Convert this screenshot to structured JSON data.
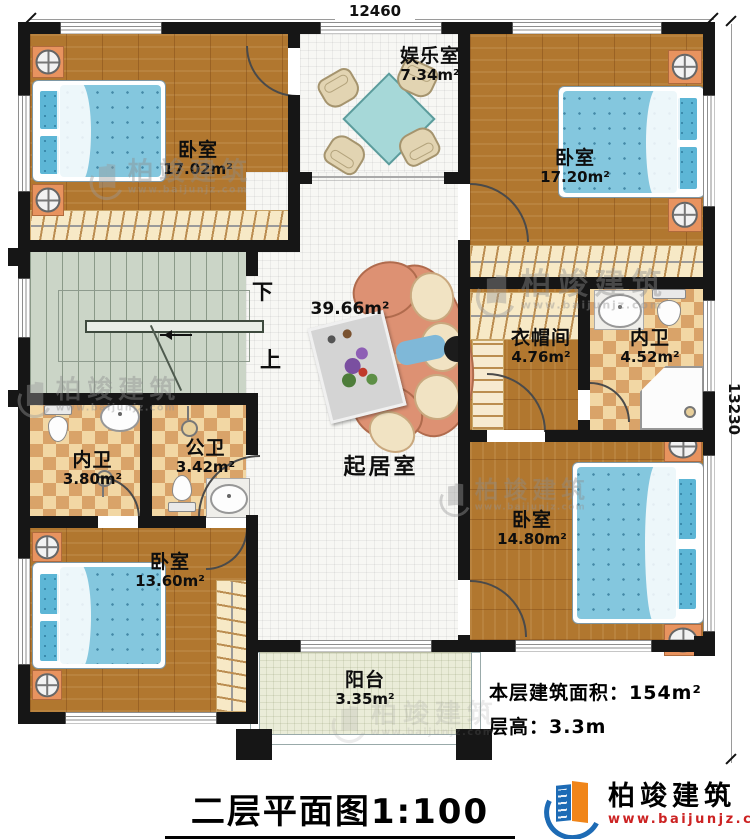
{
  "dimensions": {
    "top": "12460",
    "right": "13230"
  },
  "rooms": {
    "bedroom_tl": {
      "name": "卧室",
      "area": "17.02m²"
    },
    "entertainment": {
      "name": "娱乐室",
      "area": "7.34m²"
    },
    "bedroom_tr": {
      "name": "卧室",
      "area": "17.20m²"
    },
    "living": {
      "name": "起居室",
      "area": "39.66m²"
    },
    "cloakroom": {
      "name": "衣帽间",
      "area": "4.76m²"
    },
    "bath_ensuite_right": {
      "name": "内卫",
      "area": "4.52m²"
    },
    "bath_ensuite_left": {
      "name": "内卫",
      "area": "3.80m²"
    },
    "bath_public": {
      "name": "公卫",
      "area": "3.42m²"
    },
    "bedroom_bl": {
      "name": "卧室",
      "area": "13.60m²"
    },
    "bedroom_br": {
      "name": "卧室",
      "area": "14.80m²"
    },
    "balcony": {
      "name": "阳台",
      "area": "3.35m²"
    }
  },
  "stairs": {
    "down": "下",
    "up": "上"
  },
  "info": {
    "floor_area": "本层建筑面积：154m²",
    "floor_height": "层高：3.3m"
  },
  "title": "二层平面图1:100",
  "brand": {
    "name": "柏竣建筑",
    "url": "www.baijunjz.com"
  },
  "watermark": {
    "name": "柏竣建筑",
    "url": "www.baijunjz.com"
  },
  "colors": {
    "wall": "#161616",
    "wood": "#b1772f",
    "tile_a": "#f2d7a4",
    "tile_b": "#d9a369",
    "stair": "#cbd5c7",
    "balcony": "#eaecd8",
    "bed_blue": "#84c7de",
    "pillow_blue": "#5db6d6",
    "nightstand": "#e8935f",
    "sofa": "#dd9173",
    "cushion": "#f1e3c3",
    "closet": "#f7e9c6",
    "hanger": "#bb8d50",
    "table_teal": "#a6d8d8",
    "chair_beige": "#e2d4b2",
    "logo_blue": "#1d6bb5",
    "logo_orange": "#f08519",
    "url_red": "#cc2222"
  }
}
